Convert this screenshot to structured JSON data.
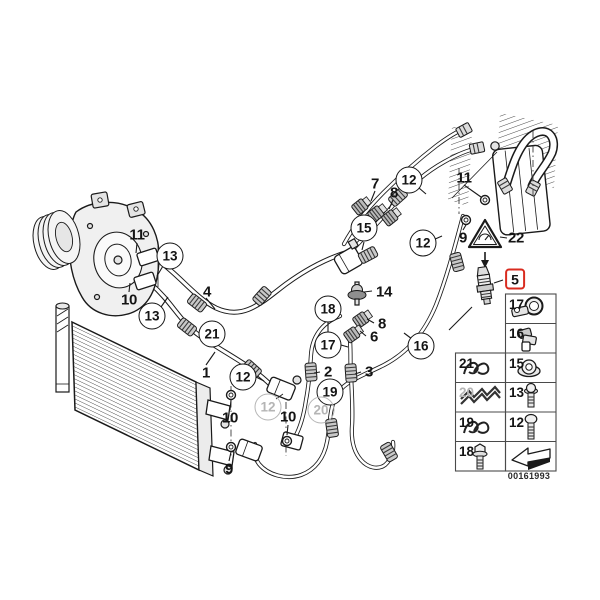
{
  "diagram": {
    "code": "00161993",
    "highlight_color": "#d92b1f",
    "gray_color": "#b5b5b5",
    "highlighted_part": "5"
  },
  "callouts": [
    {
      "label": "11",
      "style": "plain",
      "x": 137,
      "y": 235
    },
    {
      "label": "10",
      "style": "plain",
      "x": 129,
      "y": 300
    },
    {
      "label": "4",
      "style": "plain",
      "x": 207,
      "y": 292
    },
    {
      "label": "1",
      "style": "plain",
      "x": 206,
      "y": 373
    },
    {
      "label": "7",
      "style": "plain",
      "x": 375,
      "y": 184
    },
    {
      "label": "8",
      "style": "plain",
      "x": 394,
      "y": 193
    },
    {
      "label": "14",
      "style": "plain",
      "x": 384,
      "y": 292
    },
    {
      "label": "8",
      "style": "plain",
      "x": 382,
      "y": 324
    },
    {
      "label": "6",
      "style": "plain",
      "x": 374,
      "y": 337
    },
    {
      "label": "2",
      "style": "plain",
      "x": 328,
      "y": 372
    },
    {
      "label": "3",
      "style": "plain",
      "x": 369,
      "y": 372
    },
    {
      "label": "10",
      "style": "plain",
      "x": 230,
      "y": 418
    },
    {
      "label": "10",
      "style": "plain",
      "x": 288,
      "y": 417
    },
    {
      "label": "9",
      "style": "plain",
      "x": 229,
      "y": 469
    },
    {
      "label": "11",
      "style": "plain",
      "x": 464,
      "y": 178
    },
    {
      "label": "9",
      "style": "plain",
      "x": 463,
      "y": 238
    },
    {
      "label": "22",
      "style": "plain",
      "x": 516,
      "y": 238
    },
    {
      "label": "13",
      "style": "circle",
      "x": 170,
      "y": 256
    },
    {
      "label": "13",
      "style": "circle",
      "x": 152,
      "y": 316
    },
    {
      "label": "21",
      "style": "circle",
      "x": 212,
      "y": 334
    },
    {
      "label": "12",
      "style": "circle",
      "x": 243,
      "y": 377
    },
    {
      "label": "12",
      "style": "circle",
      "x": 409,
      "y": 180
    },
    {
      "label": "15",
      "style": "circle",
      "x": 364,
      "y": 228
    },
    {
      "label": "12",
      "style": "circle",
      "x": 423,
      "y": 243
    },
    {
      "label": "18",
      "style": "circle",
      "x": 328,
      "y": 309
    },
    {
      "label": "17",
      "style": "circle",
      "x": 328,
      "y": 345
    },
    {
      "label": "16",
      "style": "circle",
      "x": 421,
      "y": 346
    },
    {
      "label": "19",
      "style": "circle",
      "x": 330,
      "y": 392
    },
    {
      "label": "12",
      "style": "circle-gray",
      "x": 268,
      "y": 407
    },
    {
      "label": "20",
      "style": "circle-gray",
      "x": 321,
      "y": 410
    },
    {
      "label": "5",
      "style": "red-box",
      "x": 515,
      "y": 279
    }
  ],
  "parts_table": {
    "cells": [
      {
        "label": "17",
        "glyph": "pipe-clamp",
        "x": 509,
        "y": 297
      },
      {
        "label": "16",
        "glyph": "holder-clip",
        "x": 509,
        "y": 326
      },
      {
        "label": "21",
        "glyph": "wire-clip",
        "x": 459,
        "y": 356
      },
      {
        "label": "15",
        "glyph": "flange-nut",
        "x": 509,
        "y": 356
      },
      {
        "label": "20",
        "glyph": "corrugated-clip",
        "x": 459,
        "y": 385,
        "gray": true
      },
      {
        "label": "13",
        "glyph": "short-bolt",
        "x": 509,
        "y": 385
      },
      {
        "label": "19",
        "glyph": "wire-clip",
        "x": 459,
        "y": 415
      },
      {
        "label": "12",
        "glyph": "long-bolt",
        "x": 509,
        "y": 415
      },
      {
        "label": "18",
        "glyph": "hex-screw",
        "x": 459,
        "y": 444
      },
      {
        "label": "",
        "glyph": "direction-arrow",
        "x": 509,
        "y": 444
      }
    ]
  }
}
